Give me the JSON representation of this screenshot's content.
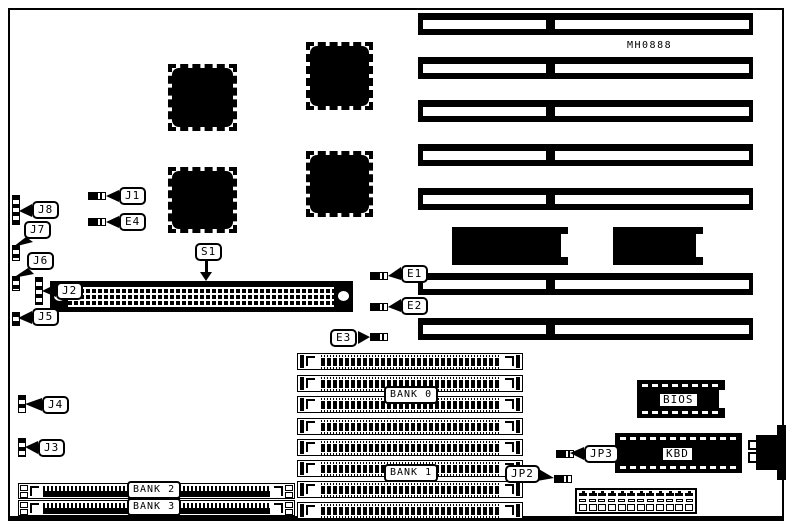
{
  "board": {
    "model": "MH0888"
  },
  "labels": {
    "s1": "S1",
    "j1": "J1",
    "j2": "J2",
    "j3": "J3",
    "j4": "J4",
    "j5": "J5",
    "j6": "J6",
    "j7": "J7",
    "j8": "J8",
    "e1": "E1",
    "e2": "E2",
    "e3": "E3",
    "e4": "E4",
    "jp2": "JP2",
    "jp3": "JP3",
    "bank0": "BANK 0",
    "bank1": "BANK 1",
    "bank2": "BANK 2",
    "bank3": "BANK 3",
    "bios": "BIOS",
    "kbd": "KBD"
  },
  "colors": {
    "ink": "#000000",
    "paper": "#ffffff"
  }
}
